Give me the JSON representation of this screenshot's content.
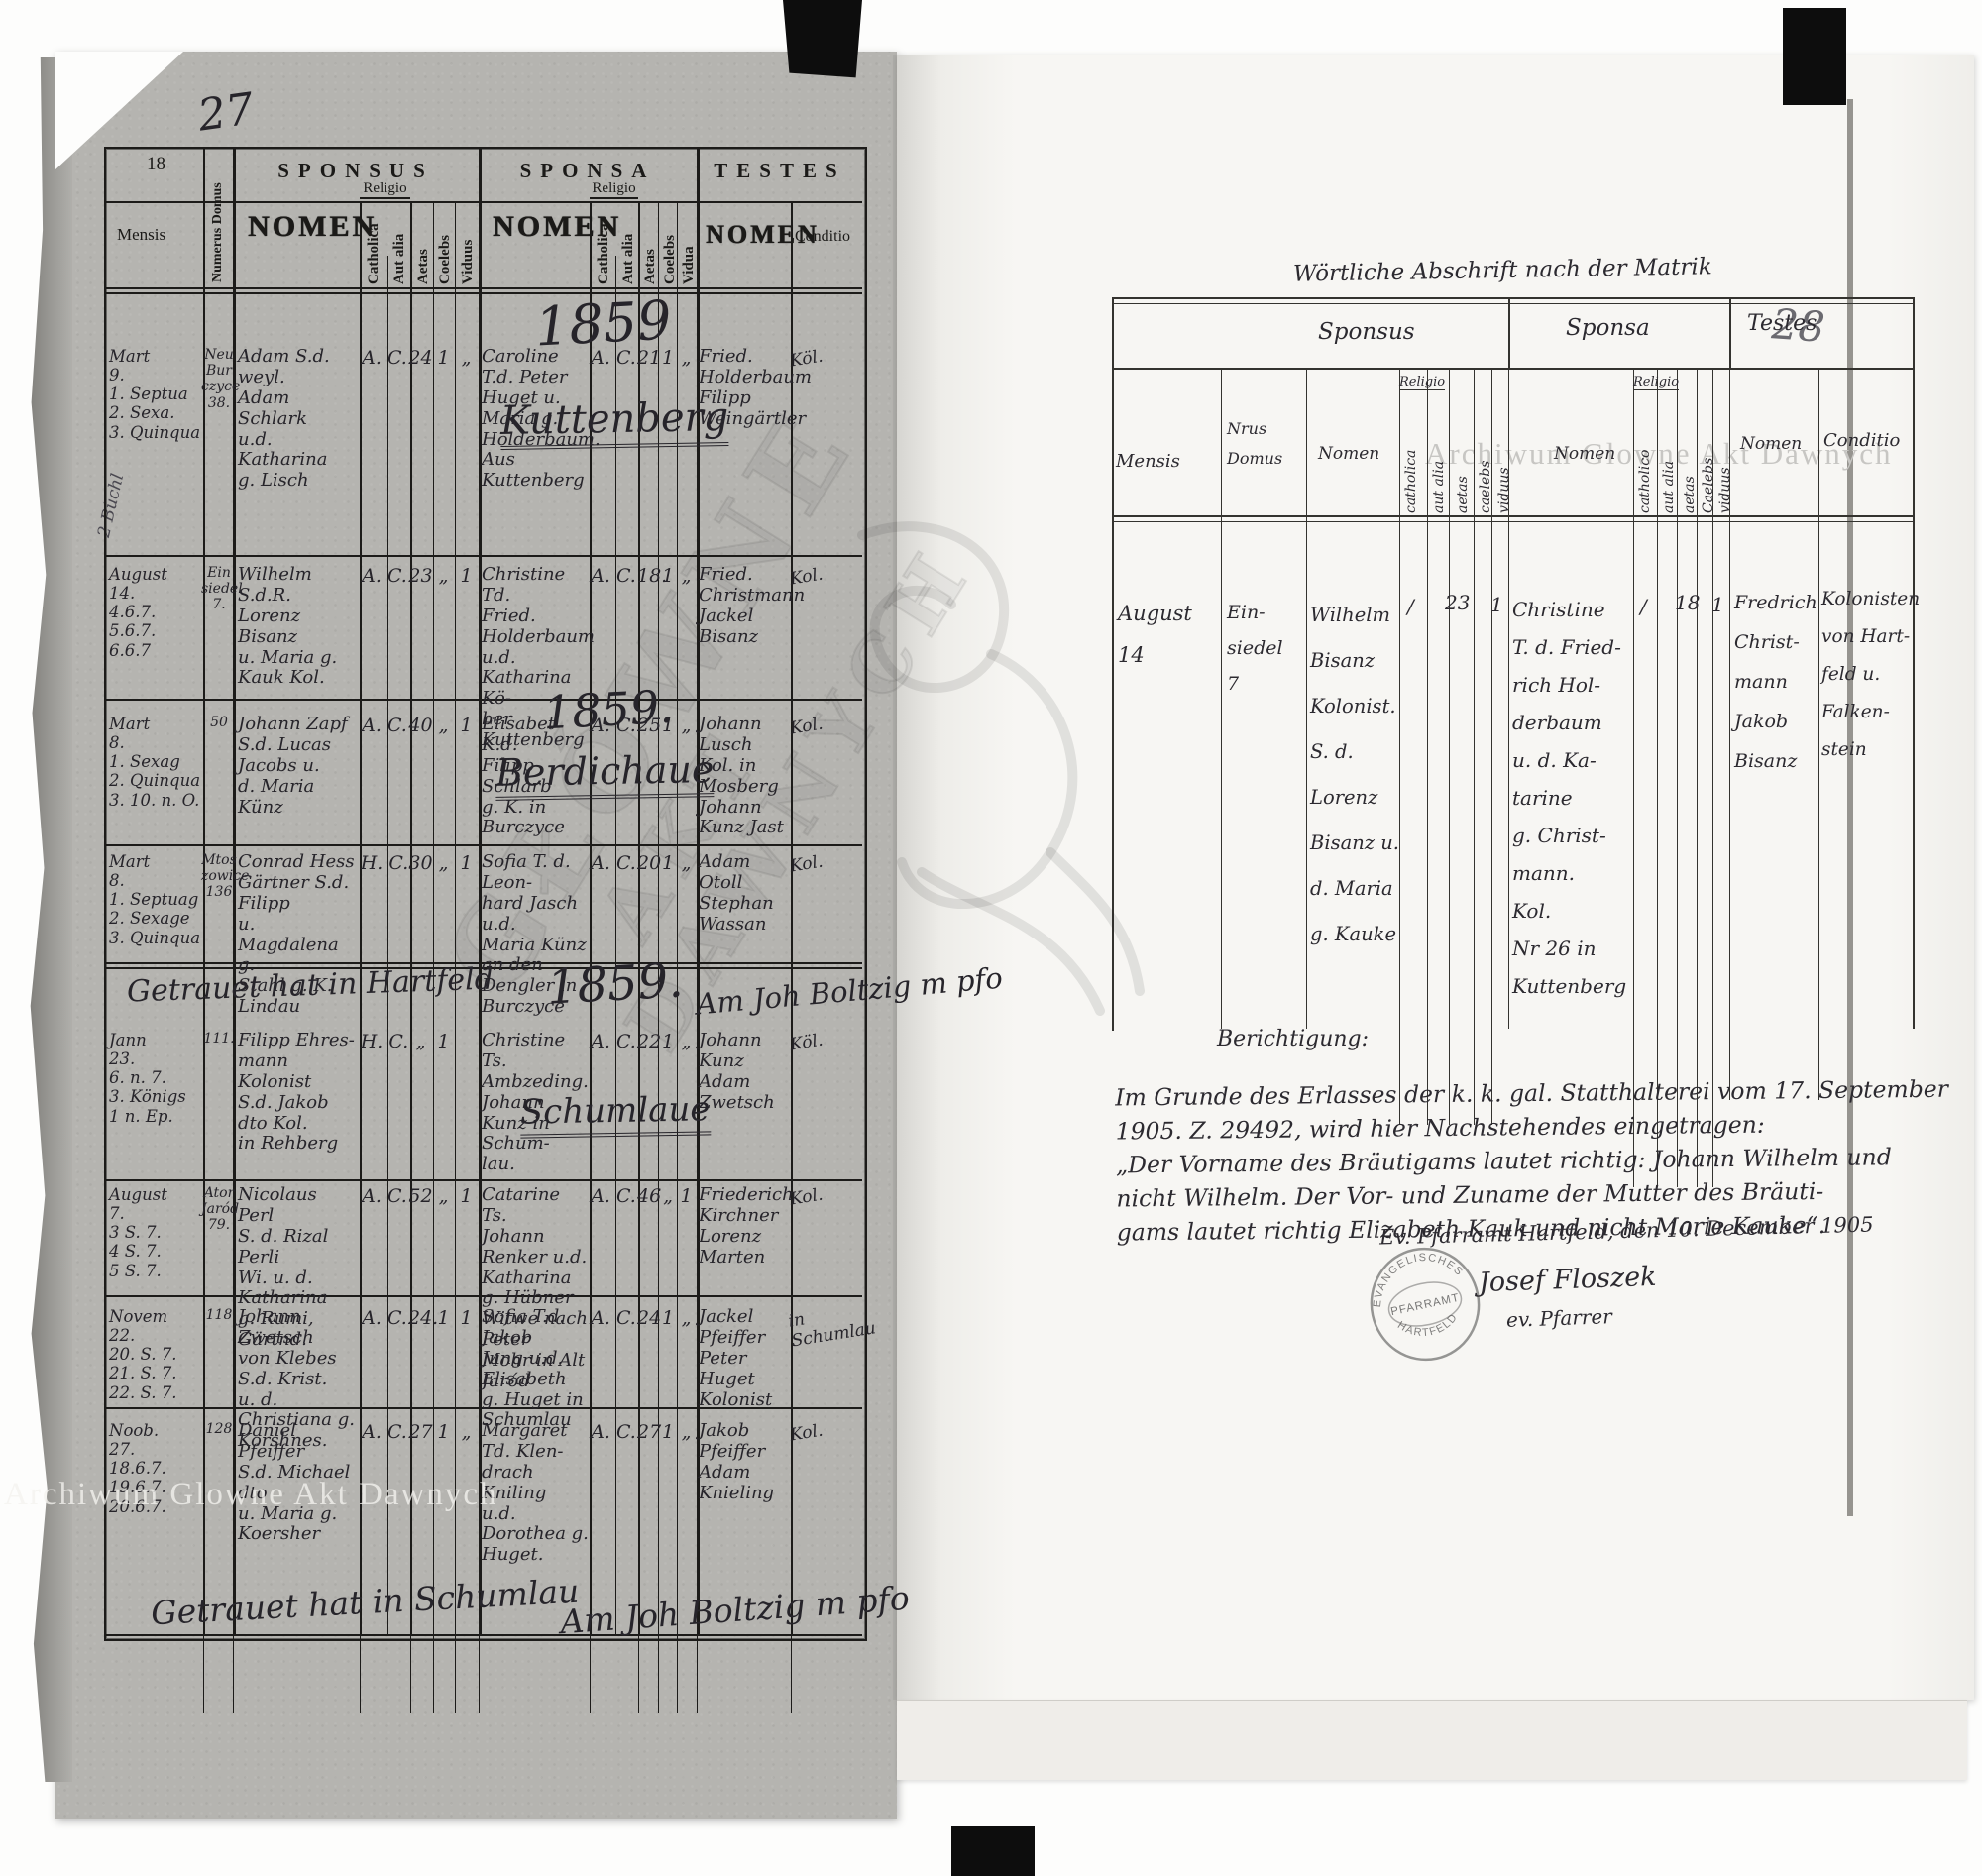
{
  "watermarks": {
    "center_line1": "GŁÓWNE",
    "center_line2": "AKT",
    "center_line3": "DAWNYCH",
    "right_top": "Archiwum Glowne Akt Dawnych",
    "left_bottom": "Archiwum Glowne Akt Dawnych"
  },
  "left_page": {
    "corner_number": "27",
    "page_number": "18",
    "margin_note": "2 Büchl",
    "header": {
      "sponsus": "SPONSUS",
      "sponsa": "SPONSA",
      "testes": "TESTES",
      "mensis": "Mensis",
      "numerus_domus": "Numerus Domus",
      "nomen_sponsus": "NOMEN",
      "nomen_sponsa": "NOMEN",
      "nomen_testes": "NOMEN",
      "religio_sponsus": "Religio",
      "religio_sponsa": "Religio",
      "catholica_sponsus": "Catholica",
      "aut_alia_sponsus": "Aut alia",
      "aetas_sponsus": "Aetas",
      "coelebs_sponsus": "Coelebs",
      "viduus_sponsus": "Viduus",
      "catholica_sponsa": "Catholica",
      "aut_alia_sponsa": "Aut alia",
      "aetas_sponsa": "Aetas",
      "coelebs_sponsa": "Coelebs",
      "vidua_sponsa": "Vidua",
      "conditio": "Conditio"
    },
    "sections": {
      "kuttenberg_year": "1859",
      "kuttenberg_place": "Kuttenberg",
      "berdichau_year": "1859.",
      "berdichau_place": "Berdichaue",
      "hartfeld_note": "Getrauet hat in Hartfeld",
      "hartfeld_year": "1859.",
      "hartfeld_sign": "Am Joh Boltzig m pfo",
      "schumlau_place": "Schumlaue",
      "footer_note": "Getrauet hat in Schumlau",
      "footer_sign": "Am Joh Boltzig m pfo"
    },
    "rows": [
      {
        "mensis": "Mart\n9.\n1. Septua\n2. Sexa.\n3. Quinqua",
        "domus": "Neu\nBur\nczyce\n38.",
        "sponsus_name": "Adam S.d. weyl.\nAdam Schlark\nu.d. Katharina\ng. Lisch",
        "sponsus_religio": "A. C.",
        "sponsus_aetas": "24",
        "sponsus_coelebs": "1",
        "sponsus_viduus": "„",
        "sponsa_name": "Caroline T.d. Peter\nHuget u. Maria g.\nHolderbaum. Aus\nKuttenberg",
        "sponsa_religio": "A. C.",
        "sponsa_aetas": "21",
        "sponsa_coelebs": "1",
        "sponsa_vidua": "„",
        "testes_name": "Fried. Holderbaum\nFilipp Weingärtler",
        "conditio": "Köl."
      },
      {
        "mensis": "August\n14.\n4.6.7.\n5.6.7.\n6.6.7",
        "domus": "Ein\nsiedel\n7.",
        "sponsus_name": "Wilhelm S.d.R.\nLorenz Bisanz\nu. Maria g. Kauk Kol.",
        "sponsus_religio": "A. C.",
        "sponsus_aetas": "23",
        "sponsus_coelebs": "„",
        "sponsus_viduus": "1",
        "sponsa_name": "Christine Td.\nFried. Holderbaum\nu.d. Katharina Kö-\nber\nKuttenberg",
        "sponsa_religio": "A. C.",
        "sponsa_aetas": "18.",
        "sponsa_coelebs": "1",
        "sponsa_vidua": "„",
        "testes_name": "Fried. Christmann\nJackel Bisanz",
        "conditio": "Kol."
      },
      {
        "mensis": "Mart\n8.\n1. Sexag\n2. Quinqua\n3. 10. n. O.",
        "domus": "50",
        "sponsus_name": "Johann Zapf\nS.d. Lucas Jacobs u.\nd. Maria Künz",
        "sponsus_religio": "A. C.",
        "sponsus_aetas": "40",
        "sponsus_coelebs": "„",
        "sponsus_viduus": "1",
        "sponsa_name": "Elisabet K.d.\nFilipp Schlarb\ng. K. in Burczyce",
        "sponsa_religio": "A. C.",
        "sponsa_aetas": "25",
        "sponsa_coelebs": "1",
        "sponsa_vidua": "„",
        "testes_name": "Johann Lusch\nKol. in Mosberg\nJohann Kunz Jast",
        "conditio": "Kol."
      },
      {
        "mensis": "Mart\n8.\n1. Septuag\n2. Sexage\n3. Quinqua",
        "domus": "Mtos\nzowice\n136",
        "sponsus_name": "Conrad Hess\nGärtner S.d. Filipp\nu. Magdalena g.\nStahl g. K. Lindau",
        "sponsus_religio": "H. C.",
        "sponsus_aetas": "30",
        "sponsus_coelebs": "„",
        "sponsus_viduus": "1",
        "sponsa_name": "Sofia T. d. Leon-\nhard Jasch u.d.\nMaria Künz an den\nDengler in Burczyce",
        "sponsa_religio": "A. C.",
        "sponsa_aetas": "20",
        "sponsa_coelebs": "1",
        "sponsa_vidua": "„",
        "testes_name": "Adam Otoll\nStephan Wassan",
        "conditio": "Kol."
      },
      {
        "mensis": "Jann\n23.\n6. n. 7.\n3. Königs\n1 n. Ep.",
        "domus": "111.",
        "sponsus_name": "Filipp Ehres-\nmann Kolonist\nS.d. Jakob dto Kol.\nin Rehberg",
        "sponsus_religio": "H. C.",
        "sponsus_aetas": "„",
        "sponsus_coelebs": "1",
        "sponsus_viduus": "",
        "sponsa_name": "Christine Ts.\nAmbzeding. Johann\nKunz in Schum-\nlau.",
        "sponsa_religio": "A. C.",
        "sponsa_aetas": "22",
        "sponsa_coelebs": "1",
        "sponsa_vidua": "„",
        "testes_name": "Johann Kunz\nAdam Zwetsch",
        "conditio": "Köl."
      },
      {
        "mensis": "August\n7.\n3 S. 7.\n4 S. 7.\n5 S. 7.",
        "domus": "Ator\nJaród\n79.",
        "sponsus_name": "Nicolaus Perl\nS. d. Rizal Perli\nWi. u. d. Katharina\ng. Rumi, Gärtnd.",
        "sponsus_religio": "A. C.",
        "sponsus_aetas": "52",
        "sponsus_coelebs": "„",
        "sponsus_viduus": "1",
        "sponsa_name": "Catarine Ts.\nJohann Renker u.d.\nKatharina g. Hübner\nWitwe nach Peter\nMohr in Alt Jaród",
        "sponsa_religio": "A. C.",
        "sponsa_aetas": "46",
        "sponsa_coelebs": "„",
        "sponsa_vidua": "1",
        "testes_name": "Friederich Kirchner\nLorenz Marten",
        "conditio": "Kol."
      },
      {
        "mensis": "Novem\n22.\n20. S. 7.\n21. S. 7.\n22. S. 7.",
        "domus": "118",
        "sponsus_name": "Johann Zwetsch\nvon Klebes S.d. Krist.\nu. d. Christiana g.\nKorshnes.",
        "sponsus_religio": "A. C.",
        "sponsus_aetas": "24.",
        "sponsus_coelebs": "1",
        "sponsus_viduus": "1",
        "sponsa_name": "Sofia T.d. Jakob\nJung u.d. Elisabeth\ng. Huget in\nSchumlau",
        "sponsa_religio": "A. C.",
        "sponsa_aetas": "24",
        "sponsa_coelebs": "1",
        "sponsa_vidua": "„",
        "testes_name": "Jackel Pfeiffer\nPeter Huget\nKolonist",
        "conditio": "in Schumlau"
      },
      {
        "mensis": "Noob.\n27.\n18.6.7.\n19.6.7.\n20.6.7.",
        "domus": "128",
        "sponsus_name": "Daniel Pfeiffer\nS.d. Michael dto\nu. Maria g.\nKoersher",
        "sponsus_religio": "A. C.",
        "sponsus_aetas": "27",
        "sponsus_coelebs": "1",
        "sponsus_viduus": "„",
        "sponsa_name": "Margaret Td. Klen-\ndrach Kniling\nu.d. Dorothea g.\nHuget.",
        "sponsa_religio": "A. C.",
        "sponsa_aetas": "27",
        "sponsa_coelebs": "1",
        "sponsa_vidua": "„",
        "testes_name": "Jakob Pfeiffer\nAdam Knieling",
        "conditio": "Kol."
      }
    ]
  },
  "right_page": {
    "title": "Wörtliche Abschrift nach der Matrik",
    "corner_number": "28",
    "header": {
      "sponsus": "Sponsus",
      "sponsa": "Sponsa",
      "testes": "Testes",
      "mensis": "Mensis",
      "nrus_domus": "Nrus\nDomus",
      "nomen_sponsus": "Nomen",
      "nomen_sponsa": "Nomen",
      "nomen_testes": "Nomen",
      "religio_sponsus": "Religio",
      "religio_sponsa": "Religio",
      "catholica_sponsus": "catholica",
      "aut_alia_sponsus": "aut alia",
      "aetas_sponsus": "aetas",
      "caelebs_sponsus": "caelebs",
      "viduus_sponsus": "viduus",
      "catholica_sponsa": "catholico",
      "aut_alia_sponsa": "aut alia",
      "aetas_sponsa": "aetas",
      "caelebs_sponsa": "Caelebs",
      "vidua_sponsa": "viduus",
      "conditio": "Conditio"
    },
    "record": {
      "mensis": "August\n14",
      "domus": "Ein-\nsiedel\n7",
      "sponsus_name": "Wilhelm\nBisanz\nKolonist.\nS. d. Lorenz\nBisanz u.\nd. Maria\ng. Kauke",
      "sponsus_catholica": "/",
      "sponsus_aetas": "23",
      "sponsus_viduus": "1",
      "sponsa_name": "Christine\nT. d. Fried-\nrich Hol-\nderbaum\nu. d. Ka-\ntarine\ng. Christ-\nmann.\nKol.\nNr 26 in\nKuttenberg",
      "sponsa_catholica": "/",
      "sponsa_aetas": "18",
      "sponsa_caelebs": "1",
      "testes_name": "Fredrich\nChrist-\nmann\nJakob\nBisanz",
      "testes_conditio": "Kolonisten\nvon Hart-\nfeld u.\nFalken-\nstein"
    },
    "berichtigung": "Berichtigung:",
    "note": "Im Grunde des Erlasses der k. k. gal. Statthalterei vom 17. September\n1905. Z. 29492, wird hier Nachstehendes eingetragen:\n„Der Vorname des Bräutigams lautet richtig: Johann Wilhelm und\nnicht Wilhelm.      Der Vor- und Zuname der Mutter des Bräuti-\ngams lautet richtig Elizabeth Kauk und nicht Marie Kauke“.",
    "signature": {
      "place_date": "Ev. Pfarramt Hartfeld, den 10. December 1905",
      "name": "Josef Floszek",
      "title": "ev. Pfarrer"
    },
    "stamp": {
      "line1": "EVANGELISCHES",
      "line2": "PFARRAMT",
      "line3": "HARTFELD"
    }
  }
}
